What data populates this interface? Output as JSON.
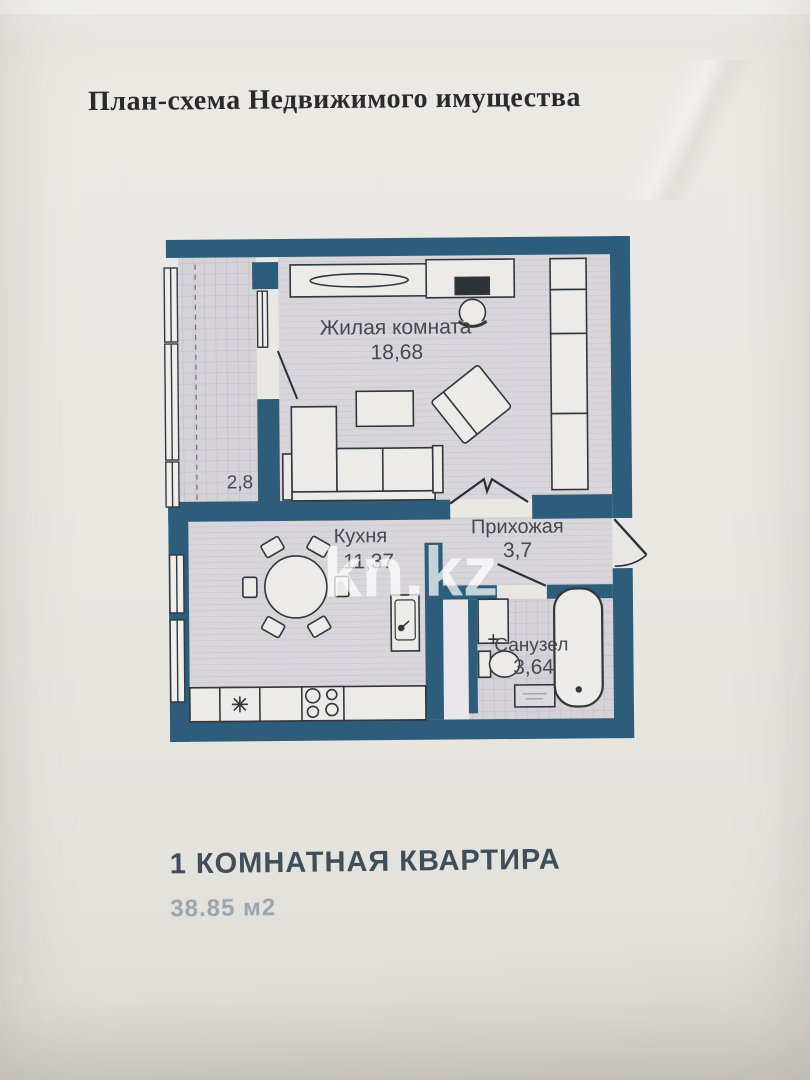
{
  "document": {
    "title": "План-схема Недвижимого имущества",
    "watermark": "kn.kz",
    "footer": {
      "line1": "1 КОМНАТНАЯ КВАРТИРА",
      "line2": "38.85 м2"
    }
  },
  "floor_plan": {
    "rooms": {
      "living": {
        "name": "Жилая комната",
        "area": "18,68"
      },
      "kitchen": {
        "name": "Кухня",
        "area": "11,37"
      },
      "hallway": {
        "name": "Прихожая",
        "area": "3,7"
      },
      "bathroom": {
        "name": "Санузел",
        "area": "3,64"
      },
      "balcony": {
        "area": "2,8"
      }
    },
    "colors": {
      "wall": "#2e5d7b",
      "floor": "#d8d5da",
      "paper": "#e9e7e2",
      "label_text": "#45484f",
      "footer_text": "#3e4e5b",
      "footer_muted": "#9ba5ae"
    }
  }
}
